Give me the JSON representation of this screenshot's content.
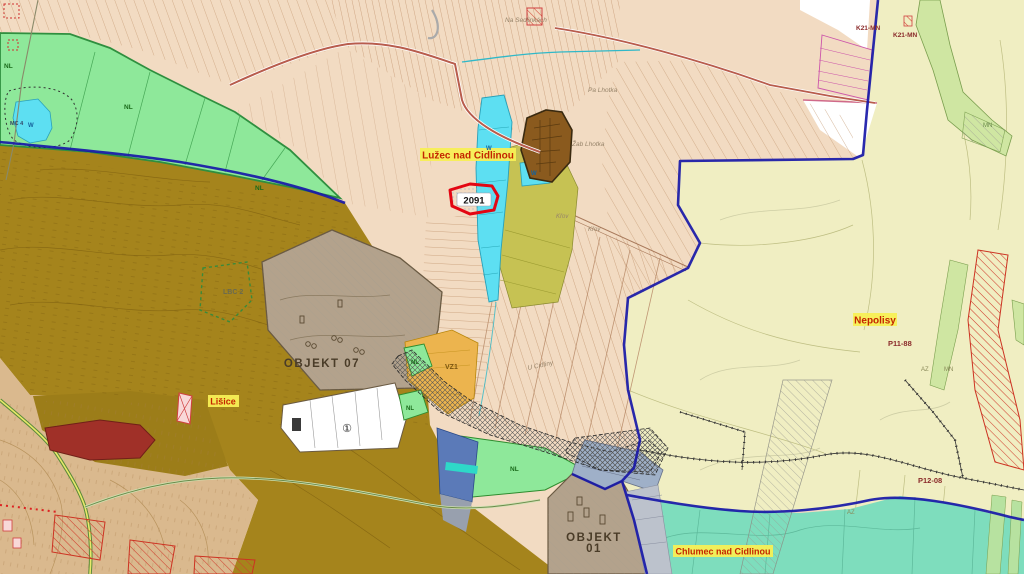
{
  "map": {
    "labels": {
      "luzec": "Lužec nad Cidlinou",
      "lisice": "Lišice",
      "nepolisy": "Nepolisy",
      "chlumec": "Chlumec nad Cidlinou",
      "objekt07": "OBJEKT 07",
      "objekt01_line1": "OBJEKT",
      "objekt01_line2": "01",
      "parcel_highlight": "2091",
      "lbc2": "LBC 2",
      "p11_88": "P11-88",
      "p12_08": "P12-08",
      "k21": [
        "K21-MN",
        "K21-MN"
      ],
      "vz1": "VZ1",
      "mc4": "MC 4",
      "circled_one": "①",
      "na_sedlinkach": "Na Sedlinkách",
      "pa_lhotka": "Pa Lhotka",
      "zab_lhotka": "Žab Lhotka",
      "krov": [
        "Křov",
        "Křov"
      ],
      "u_cidliny": "U Cidliny",
      "nl": [
        "NL",
        "NL",
        "NL",
        "NL",
        "NL",
        "NL"
      ],
      "w": [
        "W",
        "W",
        "W"
      ],
      "az": [
        "AZ",
        "AZ"
      ],
      "mn": [
        "MN",
        "MN"
      ]
    },
    "colors": {
      "parcel_tan": "#f2dbc2",
      "pale_yellow": "#f0eec2",
      "meadow_green": "#8ee89a",
      "water_cyan": "#5ddff2",
      "forest_olive": "#a5841c",
      "sand": "#dab98e",
      "taupe_object": "#b3a28c",
      "khaki": "#c6c253",
      "fort_brown": "#8a5a1e",
      "teal_zone": "#7eddbd",
      "slate_blue": "#5b7ab8",
      "amber": "#ecb44e",
      "boundary_blue": "#1818a8",
      "highlight_red": "#e30613",
      "label_yellow": "#f7ef55",
      "label_red_text": "#c42500",
      "road_red": "#b85c4c"
    }
  }
}
